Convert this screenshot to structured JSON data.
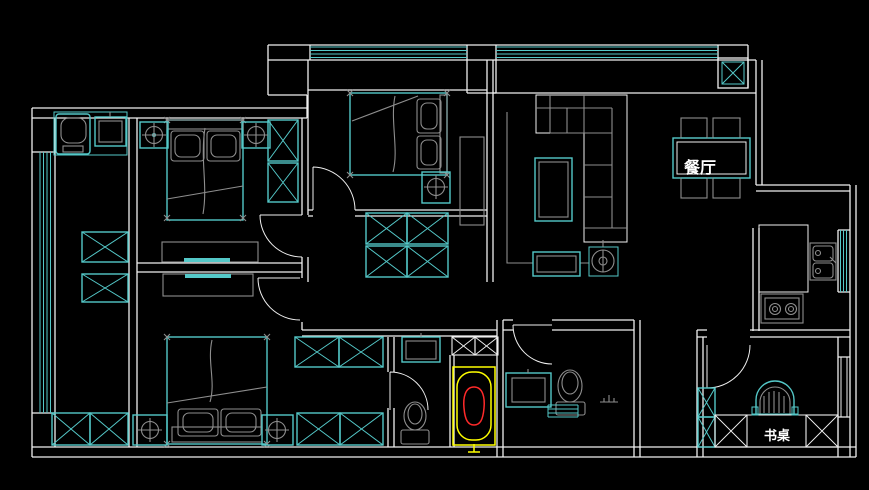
{
  "canvas": {
    "type": "cad-floor-plan",
    "width": 869,
    "height": 490,
    "background": "#000000"
  },
  "colors": {
    "wall": "#f0f0f0",
    "fixture": "#54c8c8",
    "furniture": "#8e8e8e",
    "tub": "#ffff00",
    "water": "#ff2a2a",
    "text": "#ffffff"
  },
  "labels": {
    "dining_room": "餐厅",
    "desk": "书桌"
  }
}
